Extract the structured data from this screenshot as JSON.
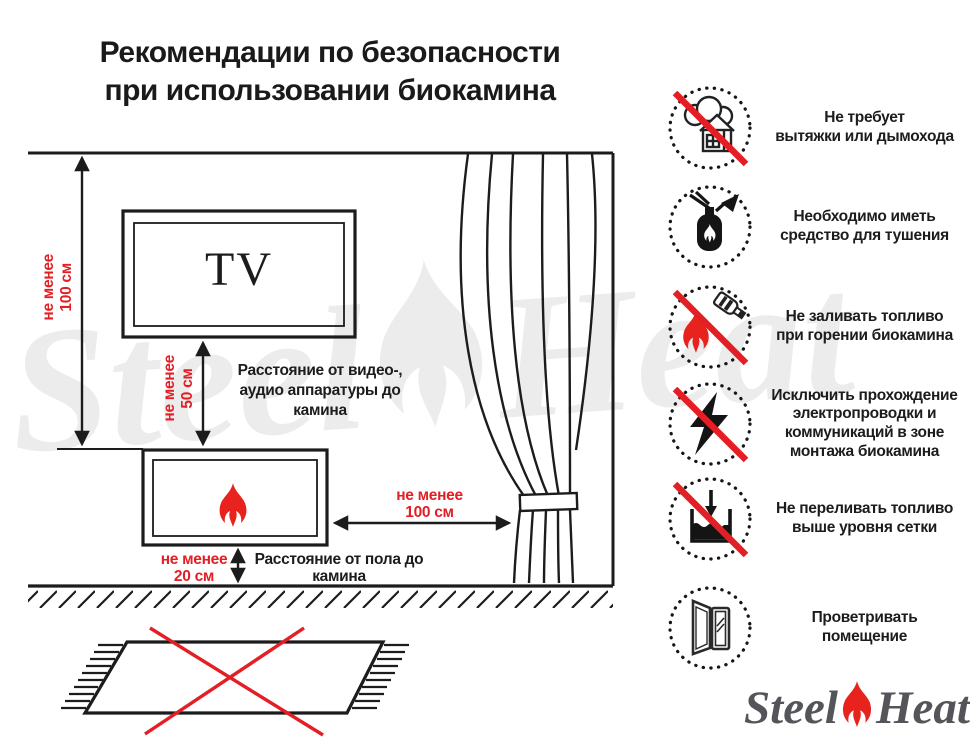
{
  "colors": {
    "accent_red": "#e31e24",
    "line_black": "#1c1c1c",
    "logo_gray": "#54555a",
    "watermark_gray": "#ececec"
  },
  "title": {
    "lines": [
      "Рекомендации по безопасности",
      "при использовании биокамина"
    ]
  },
  "diagram": {
    "tv_label": "TV",
    "wall_clearance": {
      "lines": [
        "не менее",
        "100 см"
      ]
    },
    "tv_clearance": {
      "lines": [
        "не менее",
        "50 см"
      ]
    },
    "tv_clearance_desc": {
      "lines": [
        "Расстояние от видео-,",
        "аудио аппаратуры до",
        "камина"
      ]
    },
    "curtain_clearance": {
      "lines": [
        "не менее",
        "100 см"
      ]
    },
    "floor_clearance": {
      "lines": [
        "не менее",
        "20 см"
      ]
    },
    "floor_clearance_desc": {
      "lines": [
        "Расстояние от пола до",
        "камина"
      ]
    }
  },
  "safety": {
    "items": [
      {
        "icon": "no-chimney",
        "prohibition": true,
        "lines": [
          "Не требует",
          "вытяжки или дымохода"
        ]
      },
      {
        "icon": "fire-extinguisher",
        "prohibition": false,
        "lines": [
          "Необходимо иметь",
          "средство для тушения"
        ]
      },
      {
        "icon": "no-refueling-while-burning",
        "prohibition": true,
        "lines": [
          "Не заливать топливо",
          "при горении биокамина"
        ]
      },
      {
        "icon": "no-electrical-wiring",
        "prohibition": true,
        "lines": [
          "Исключить прохождение",
          "электропроводки и",
          "коммуникаций в зоне",
          "монтажа биокамина"
        ]
      },
      {
        "icon": "no-overfilling",
        "prohibition": true,
        "lines": [
          "Не переливать топливо",
          "выше уровня сетки"
        ]
      },
      {
        "icon": "ventilate-room",
        "prohibition": false,
        "lines": [
          "Проветривать",
          "помещение"
        ]
      }
    ]
  },
  "logo": {
    "steel": "Steel",
    "heat": "Heat"
  },
  "watermark": {
    "steel": "Steel",
    "heat": "Heat"
  }
}
